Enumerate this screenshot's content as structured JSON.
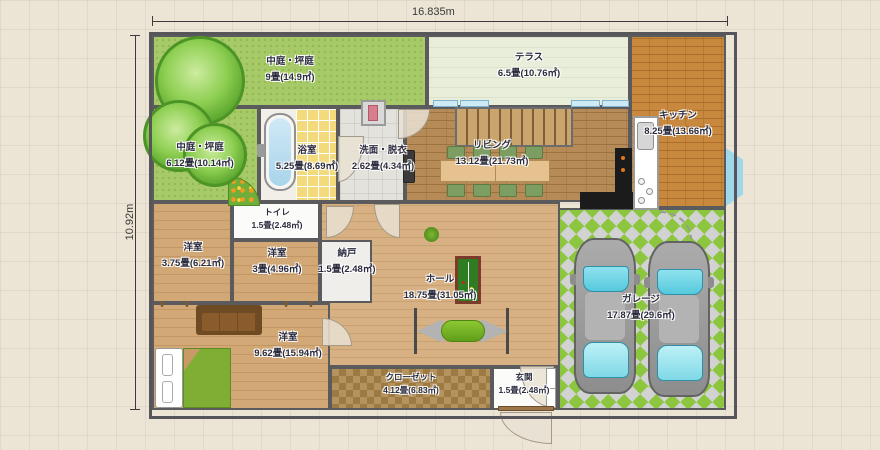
{
  "dimensions": {
    "top": "16.835m",
    "left": "10.92m"
  },
  "rooms": {
    "courtyard_top": {
      "name": "中庭・坪庭",
      "size": "9畳(14.9㎡)"
    },
    "terrace": {
      "name": "テラス",
      "size": "6.5畳(10.76㎡)"
    },
    "kitchen": {
      "name": "キッチン",
      "size": "8.25畳(13.66㎡)"
    },
    "courtyard_left": {
      "name": "中庭・坪庭",
      "size": "6.12畳(10.14㎡)"
    },
    "bathroom": {
      "name": "浴室",
      "size": "5.25畳(8.69㎡)"
    },
    "washroom": {
      "name": "洗面・脱衣",
      "size": "2.62畳(4.34㎡)"
    },
    "living": {
      "name": "リビング",
      "size": "13.12畳(21.73㎡)"
    },
    "toilet": {
      "name": "トイレ",
      "size": "1.5畳(2.48㎡)"
    },
    "bedroom_a": {
      "name": "洋室",
      "size": "3.75畳(6.21㎡)"
    },
    "bedroom_b": {
      "name": "洋室",
      "size": "3畳(4.96㎡)"
    },
    "storage": {
      "name": "納戸",
      "size": "1.5畳(2.48㎡)"
    },
    "hall": {
      "name": "ホール",
      "size": "18.75畳(31.05㎡)"
    },
    "bedroom_c": {
      "name": "洋室",
      "size": "9.62畳(15.94㎡)"
    },
    "closet": {
      "name": "クローゼット",
      "size": "4.12畳(6.83㎡)"
    },
    "entrance": {
      "name": "玄関",
      "size": "1.5畳(2.48㎡)"
    },
    "garage": {
      "name": "ガレージ",
      "size": "17.87畳(29.6㎡)"
    }
  },
  "icons": {
    "window_marks": "∨ ∨"
  },
  "colors": {
    "wall": "#5b5b5e",
    "courtyard_green": "#a7ca69",
    "terrace": "#e9eedb",
    "kitchen_floor": "#c8893e",
    "living_floor": "#b78b58",
    "hall_floor": "#d7b183",
    "garage_green": "#8cc63f",
    "tile_yellow": "#f3da7c",
    "car_glass": "#55cadd",
    "closet_brown": "#9c7a42",
    "bed_green": "#7fae35"
  }
}
